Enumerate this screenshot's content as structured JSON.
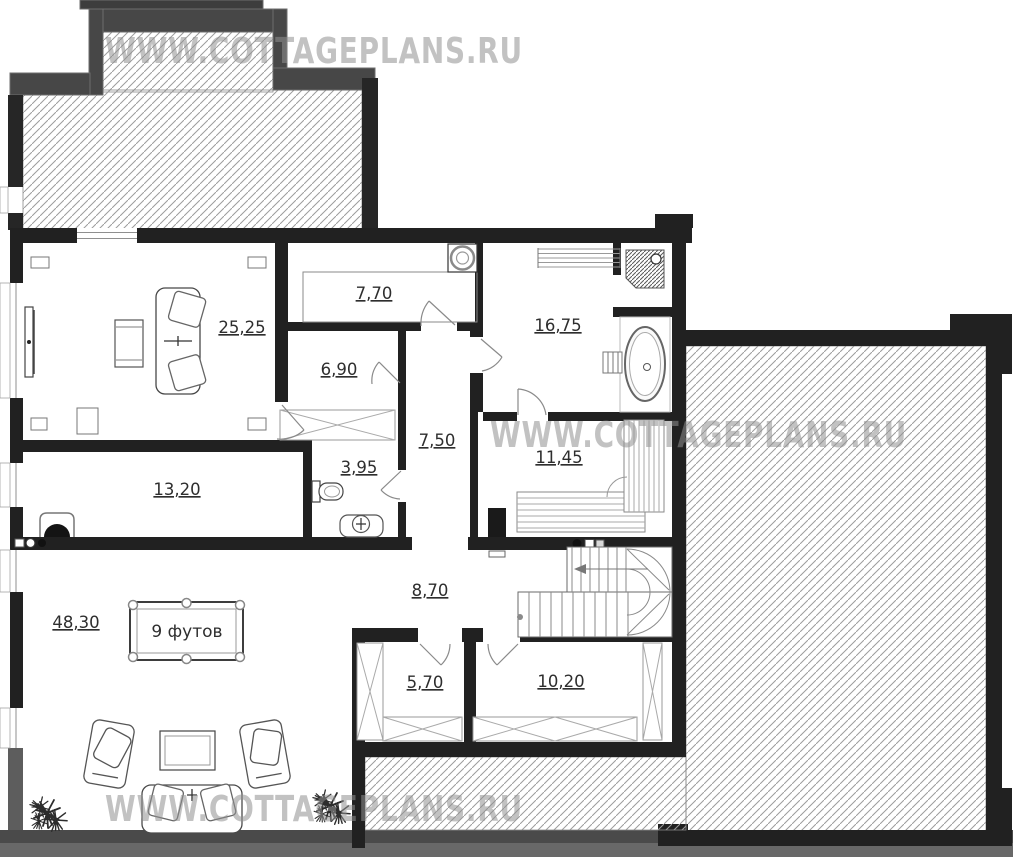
{
  "watermark": {
    "text": "WWW.COTTAGEPLANS.RU",
    "color": "#8f8f8f"
  },
  "floor_plan": {
    "room_areas": {
      "living_room": "25,25",
      "kitchen": "7,70",
      "bathroom": "16,75",
      "hallway": "6,90",
      "corridor": "7,50",
      "wc": "3,95",
      "sauna": "11,45",
      "study": "13,20",
      "billiard_room": "48,30",
      "hall": "8,70",
      "closet_small": "5,70",
      "closet_large": "10,20"
    },
    "billiard_table_label": "9 футов"
  },
  "colors": {
    "wall": "#212121",
    "porch_band": "#474747",
    "hatch_line": "#9c9c9c",
    "label_text": "#2e2e2e"
  }
}
